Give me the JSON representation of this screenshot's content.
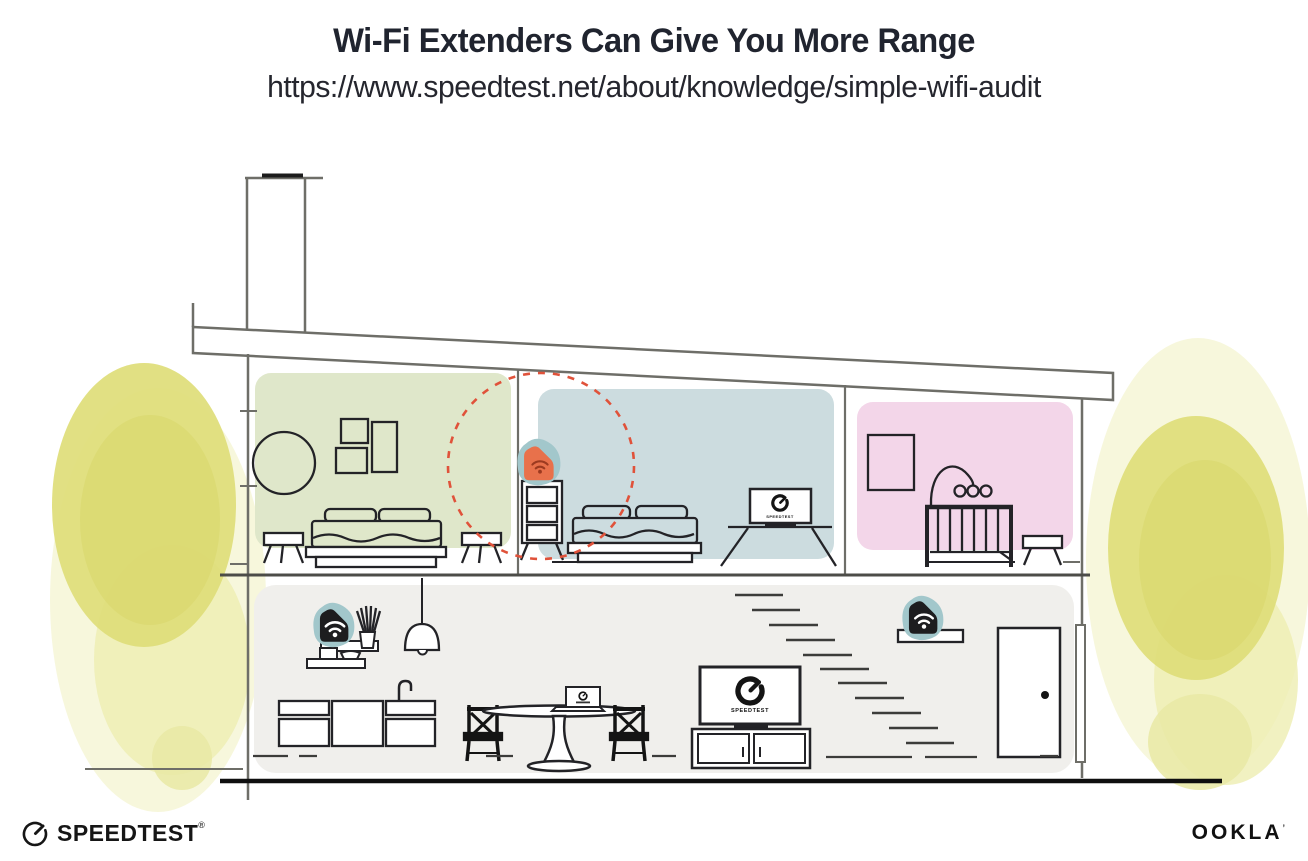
{
  "header": {
    "title": "Wi-Fi Extenders Can Give You More Range",
    "url": "https://www.speedtest.net/about/knowledge/simple-wifi-audit"
  },
  "footer": {
    "speedtest_label": "SPEEDTEST",
    "speedtest_reg": "®",
    "ookla_label": "OOKLA",
    "ookla_mark": "’"
  },
  "illustration": {
    "description": "Cross-section of a house: Wi-Fi router on ground floor, extenders upstairs and near stairs; orange extender shows extended coverage circle",
    "tv_label": "SPEEDTEST",
    "rooms": [
      {
        "id": "bedroom-left",
        "color": "#dfe7ca"
      },
      {
        "id": "bedroom-middle",
        "color": "#ccdcdf"
      },
      {
        "id": "nursery",
        "color": "#f3d6e9"
      },
      {
        "id": "ground-floor",
        "color": "#f0efec"
      }
    ],
    "devices": [
      {
        "id": "wifi-extender-upstairs",
        "style": "highlighted",
        "color": "#e8714b",
        "icon_color": "#9c3a20"
      },
      {
        "id": "wifi-router-ground-left",
        "style": "black",
        "color": "#1d1d1f",
        "icon_color": "#ffffff"
      },
      {
        "id": "wifi-extender-ground-right",
        "style": "black",
        "color": "#1d1d1f",
        "icon_color": "#ffffff"
      }
    ],
    "accent_teal": "#a2c7cb",
    "coverage_circle_color": "#e0523a",
    "tree_color": "#dedd78",
    "structure_line_color": "#6e6e68",
    "furniture_line_color": "#232327"
  }
}
